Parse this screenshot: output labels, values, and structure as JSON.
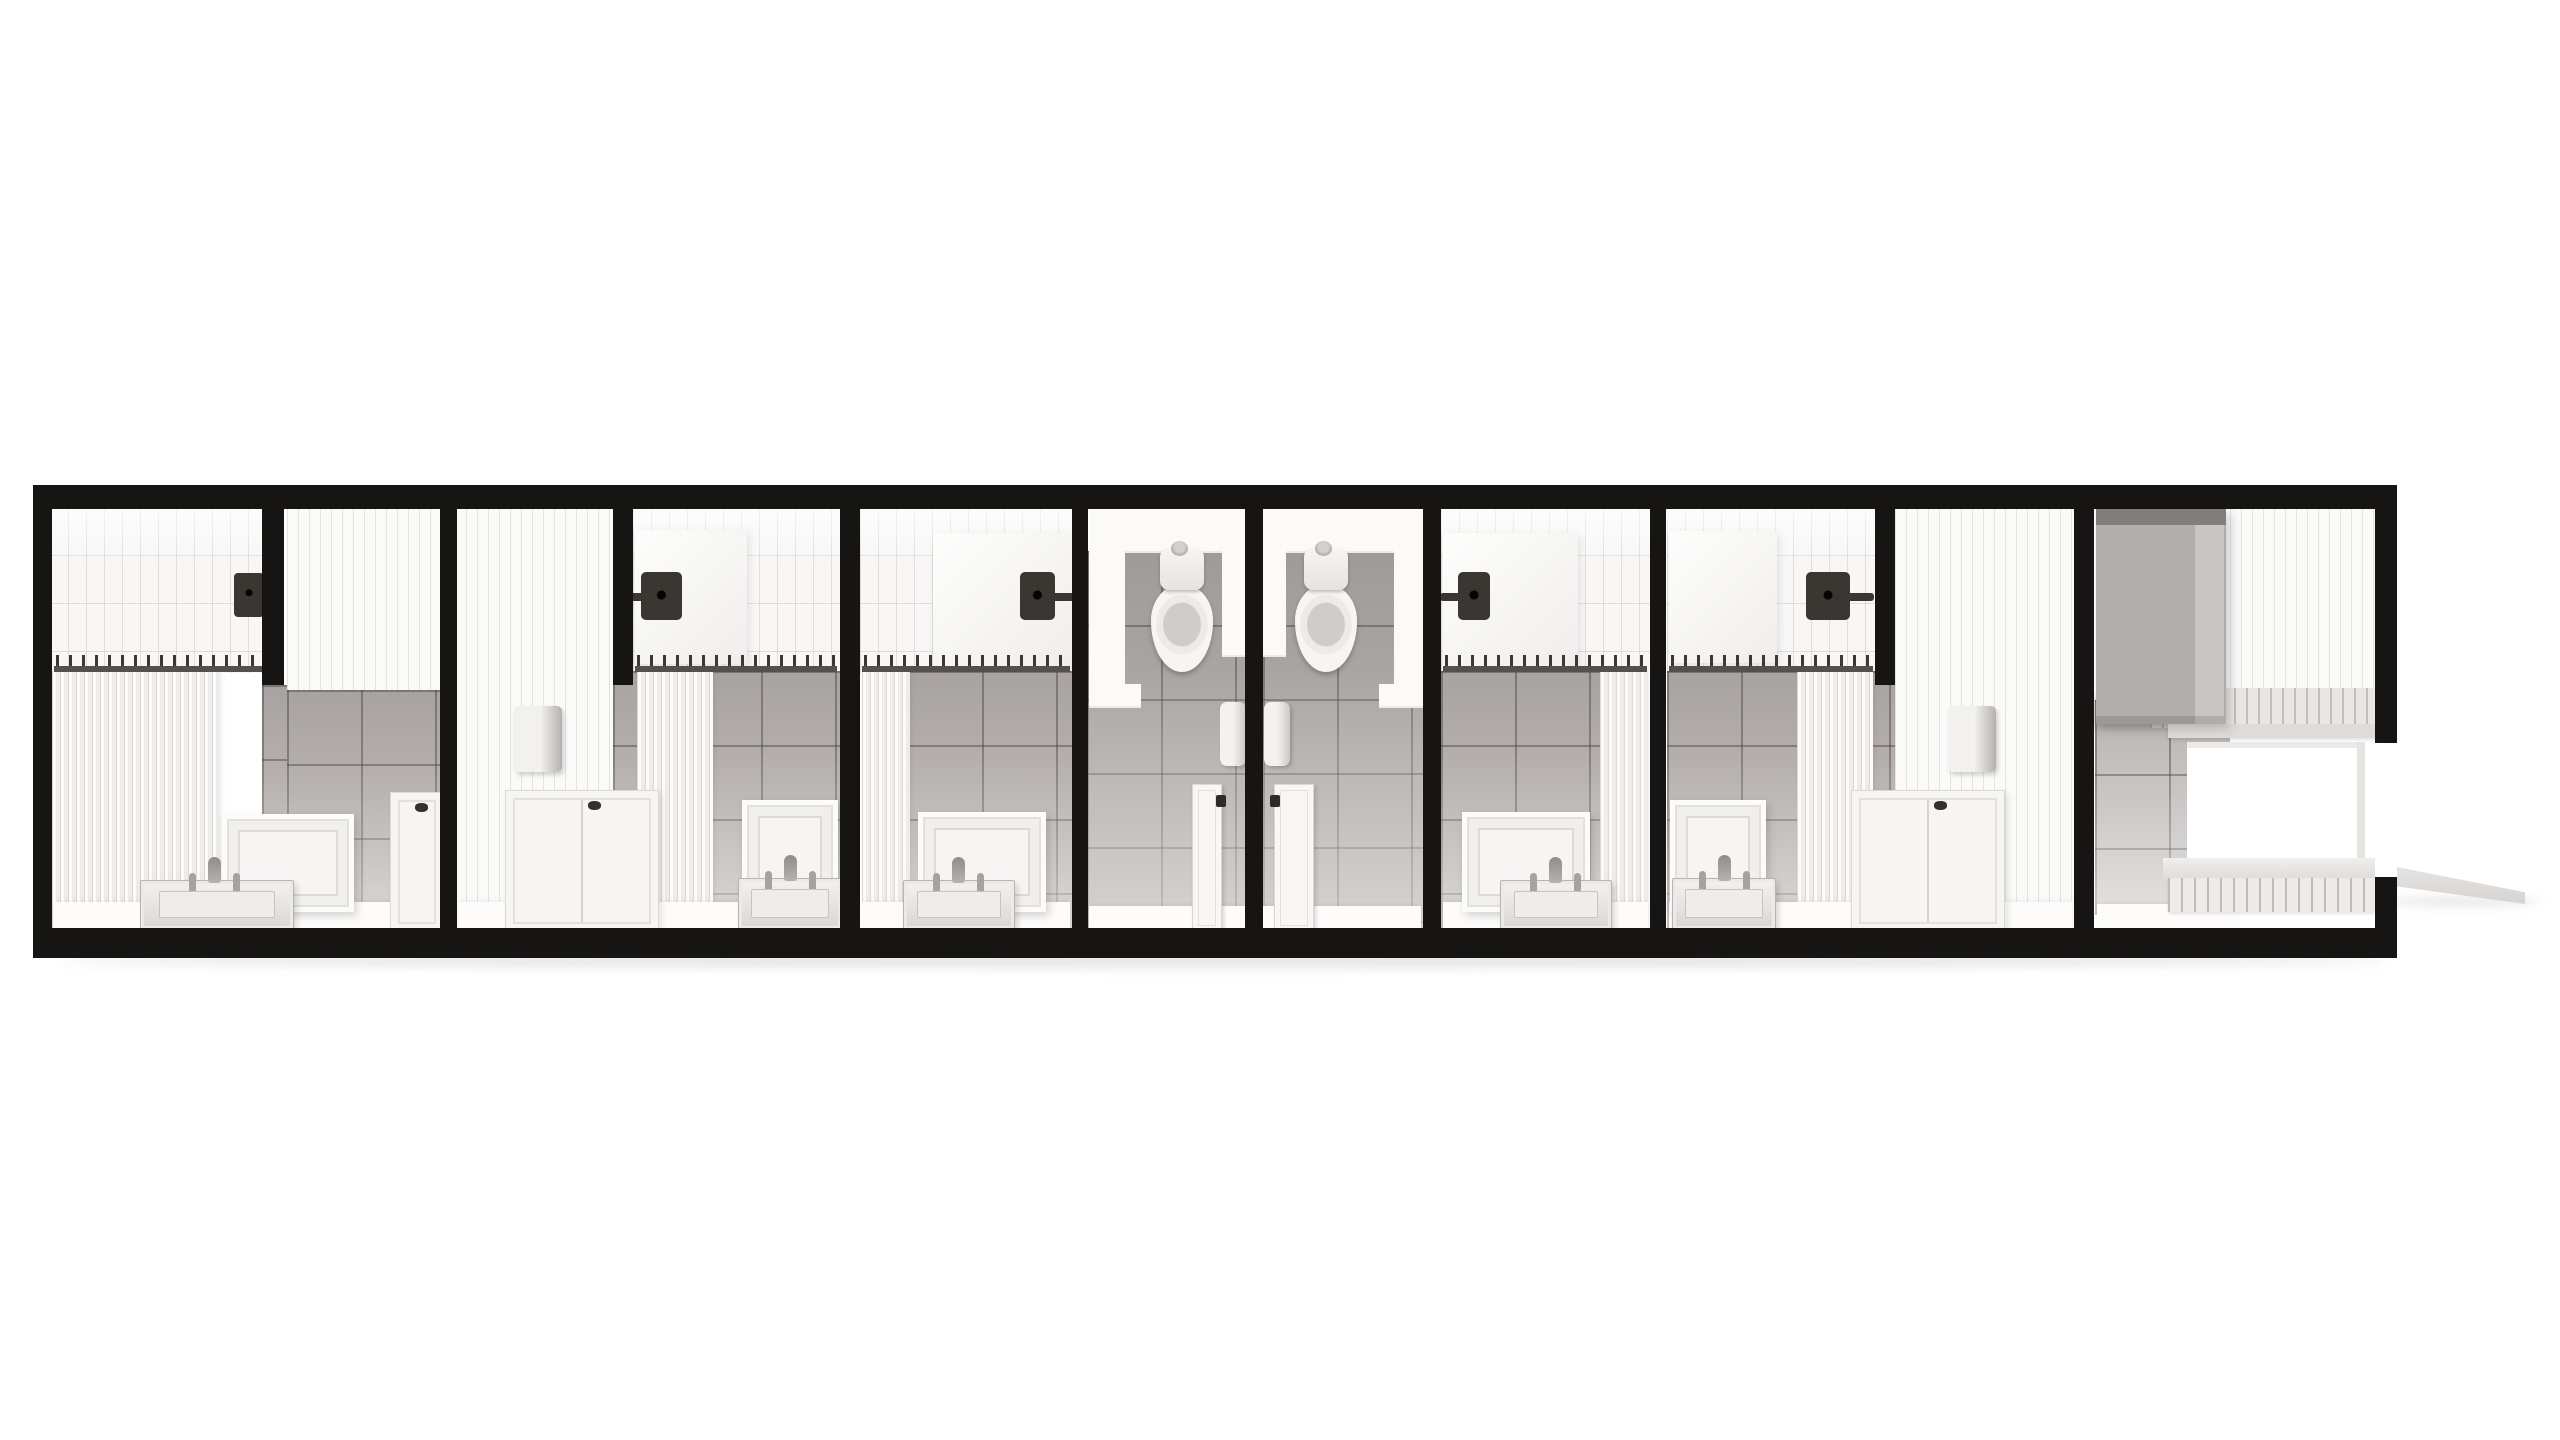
{
  "meta": {
    "scene_label": "Overhead cutaway 3D render of a modular restroom unit: four shower rooms with curtain rods and vanities, two central toilet stalls, panelled storage walls and an entry vestibule with exterior ramp",
    "render_style": "monochrome architectural visualization",
    "view": "top-down dollhouse cutaway"
  },
  "colors": {
    "bg": "#ffffff",
    "frame": "#171514",
    "subway": "#f8f7f6",
    "subwayLine": "rgba(140,134,128,0.22)",
    "panel": "#fafaf9",
    "panelLine": "rgba(140,134,128,0.20)",
    "grayTile": "#b2adab",
    "grayTileDark": "#a8a4a2",
    "grayTileLight": "#c2bfbd",
    "grayLine": "rgba(70,66,63,0.45)",
    "alcove": "#fbfaf9",
    "floorWhite": "#fdfcfb",
    "dark": "#3a3632",
    "rod": "#55504b",
    "rodRing": "#3c3835",
    "heater": "#b2aeac",
    "heaterTop": "#827e7b",
    "shadow": "rgba(100,95,90,0.16)"
  },
  "sections": [
    {
      "id": "suite-1",
      "label": "shower suite with subway-tile shower, curtain, vanity sink and cabinet"
    },
    {
      "id": "suite-2",
      "label": "shower suite with panelled wall, hand dryer, cabinet and vanity sink"
    },
    {
      "id": "shower-room-e",
      "label": "shower room with rain head, curtain and vanity sink"
    },
    {
      "id": "toilet-stall-1",
      "label": "toilet stall with toilet, paper dispenser and swing door"
    },
    {
      "id": "toilet-stall-2",
      "label": "toilet stall with toilet, paper dispenser and swing door"
    },
    {
      "id": "shower-room-f",
      "label": "shower room with rain head, curtain and vanity sink"
    },
    {
      "id": "suite-4",
      "label": "shower suite with panelled wall, hand dryer, cabinet and vanity sink"
    },
    {
      "id": "entry-vestibule",
      "label": "entry vestibule with water heater cabinet, doorway, steps and exterior ramp"
    }
  ],
  "elements": [
    {
      "n": "ground-shadow",
      "k": "shadow",
      "x": 60,
      "y": 954,
      "w": 2330,
      "h": 14
    },
    {
      "n": "ramp-shadow",
      "k": "shadow",
      "x": 2388,
      "y": 897,
      "w": 152,
      "h": 9
    },
    {
      "n": "entry-ramp",
      "k": "ramp",
      "x": 2397,
      "y": 862,
      "w": 128,
      "h": 42
    },
    {
      "n": "shower1-subway-wall",
      "k": "subway",
      "x": 50,
      "y": 507,
      "w": 217,
      "h": 166
    },
    {
      "n": "shower2-subway-wall",
      "k": "subway",
      "x": 633,
      "y": 507,
      "w": 207,
      "h": 166
    },
    {
      "n": "shower3-subway-wall",
      "k": "subway",
      "x": 860,
      "y": 507,
      "w": 212,
      "h": 166
    },
    {
      "n": "shower4-subway-wall",
      "k": "subway",
      "x": 1441,
      "y": 507,
      "w": 209,
      "h": 166
    },
    {
      "n": "shower5-subway-wall",
      "k": "subway",
      "x": 1667,
      "y": 507,
      "w": 208,
      "h": 166
    },
    {
      "n": "suite1-panel-wall",
      "k": "panels",
      "x": 287,
      "y": 507,
      "w": 153,
      "h": 268
    },
    {
      "n": "suite2-panel-wall",
      "k": "panels",
      "x": 455,
      "y": 507,
      "w": 158,
      "h": 422
    },
    {
      "n": "suite4-panel-wall",
      "k": "panels",
      "x": 1895,
      "y": 507,
      "w": 179,
      "h": 422
    },
    {
      "n": "vestibule-panel-wall",
      "k": "panels",
      "x": 2230,
      "y": 507,
      "w": 146,
      "h": 222
    },
    {
      "n": "shower2-surround",
      "k": "inset",
      "x": 635,
      "y": 530,
      "w": 112,
      "h": 134
    },
    {
      "n": "shower3-surround",
      "k": "inset",
      "x": 933,
      "y": 533,
      "w": 139,
      "h": 134
    },
    {
      "n": "shower4-surround",
      "k": "inset",
      "x": 1443,
      "y": 533,
      "w": 135,
      "h": 134
    },
    {
      "n": "shower5-surround",
      "k": "inset",
      "x": 1669,
      "y": 531,
      "w": 108,
      "h": 132
    },
    {
      "n": "suite1-halfwall-tile",
      "k": "graytile",
      "x": 262,
      "y": 685,
      "w": 25,
      "h": 245
    },
    {
      "n": "suite1-lower-tile",
      "k": "graytile",
      "x": 287,
      "y": 690,
      "w": 153,
      "h": 240
    },
    {
      "n": "suite2-lower-tile",
      "k": "graytile",
      "x": 613,
      "y": 671,
      "w": 227,
      "h": 259
    },
    {
      "n": "shower3-lower-tile",
      "k": "graytile",
      "x": 908,
      "y": 671,
      "w": 164,
      "h": 259
    },
    {
      "n": "shower4-lower-tile",
      "k": "graytile",
      "x": 1441,
      "y": 671,
      "w": 162,
      "h": 259
    },
    {
      "n": "suite4-lower-tile",
      "k": "graytile",
      "x": 1667,
      "y": 671,
      "w": 228,
      "h": 259
    },
    {
      "n": "stall1-tile",
      "k": "graytileD",
      "x": 1087,
      "y": 551,
      "w": 158,
      "h": 379
    },
    {
      "n": "stall2-tile",
      "k": "graytileD",
      "x": 1263,
      "y": 551,
      "w": 160,
      "h": 379
    },
    {
      "n": "vestibule-tile",
      "k": "graytileL",
      "x": 2095,
      "y": 700,
      "w": 135,
      "h": 215
    },
    {
      "n": "stall1-alcove-head",
      "k": "alcove",
      "x": 1089,
      "y": 509,
      "w": 156,
      "h": 44
    },
    {
      "n": "stall1-alcove-jamb-left",
      "k": "alcove",
      "x": 1089,
      "y": 509,
      "w": 36,
      "h": 194
    },
    {
      "n": "stall1-alcove-jamb-right",
      "k": "alcove",
      "x": 1222,
      "y": 509,
      "w": 23,
      "h": 148
    },
    {
      "n": "stall1-jamb-foot",
      "k": "alcove",
      "x": 1089,
      "y": 684,
      "w": 52,
      "h": 24
    },
    {
      "n": "stall2-alcove-head",
      "k": "alcove",
      "x": 1263,
      "y": 509,
      "w": 156,
      "h": 44
    },
    {
      "n": "stall2-alcove-jamb-left",
      "k": "alcove",
      "x": 1263,
      "y": 509,
      "w": 23,
      "h": 148
    },
    {
      "n": "stall2-alcove-jamb-right",
      "k": "alcove",
      "x": 1394,
      "y": 509,
      "w": 36,
      "h": 194
    },
    {
      "n": "stall2-jamb-foot",
      "k": "alcove",
      "x": 1379,
      "y": 684,
      "w": 52,
      "h": 24
    },
    {
      "n": "shower1-curtain",
      "k": "pleats",
      "x": 52,
      "y": 671,
      "w": 168,
      "h": 259
    },
    {
      "n": "shower2-curtain",
      "k": "pleats",
      "x": 637,
      "y": 671,
      "w": 76,
      "h": 259
    },
    {
      "n": "shower3-curtain",
      "k": "pleats",
      "x": 862,
      "y": 671,
      "w": 48,
      "h": 259
    },
    {
      "n": "shower4-curtain",
      "k": "pleats",
      "x": 1600,
      "y": 671,
      "w": 48,
      "h": 259
    },
    {
      "n": "shower5-curtain",
      "k": "pleats",
      "x": 1797,
      "y": 671,
      "w": 76,
      "h": 259
    },
    {
      "n": "suite1-floor",
      "k": "floor",
      "x": 54,
      "y": 902,
      "w": 384,
      "h": 28
    },
    {
      "n": "suite2-floor",
      "k": "floor",
      "x": 458,
      "y": 902,
      "w": 380,
      "h": 28
    },
    {
      "n": "shower3-floor",
      "k": "floor",
      "x": 862,
      "y": 902,
      "w": 208,
      "h": 28
    },
    {
      "n": "shower4-floor",
      "k": "floor",
      "x": 1443,
      "y": 902,
      "w": 205,
      "h": 28
    },
    {
      "n": "suite4-floor",
      "k": "floor",
      "x": 1669,
      "y": 902,
      "w": 403,
      "h": 28
    },
    {
      "n": "stall1-floor",
      "k": "floor",
      "x": 1089,
      "y": 906,
      "w": 156,
      "h": 24
    },
    {
      "n": "stall2-floor",
      "k": "floor",
      "x": 1263,
      "y": 906,
      "w": 158,
      "h": 24
    },
    {
      "n": "vestibule-floor",
      "k": "floor",
      "x": 2097,
      "y": 904,
      "w": 140,
      "h": 26
    },
    {
      "n": "vestibule-slat-band",
      "k": "slatband",
      "x": 2150,
      "y": 688,
      "w": 227,
      "h": 40
    },
    {
      "n": "vestibule-ledge",
      "k": "ledge",
      "x": 2168,
      "y": 724,
      "w": 209,
      "h": 14
    },
    {
      "n": "vestibule-doorway",
      "k": "doorway",
      "x": 2187,
      "y": 742,
      "w": 178,
      "h": 150
    },
    {
      "n": "vestibule-step-tread",
      "k": "tread",
      "x": 2163,
      "y": 858,
      "w": 212,
      "h": 24
    },
    {
      "n": "vestibule-step-slats",
      "k": "slats",
      "x": 2168,
      "y": 878,
      "w": 207,
      "h": 34
    },
    {
      "n": "water-heater-cabinet",
      "k": "heater",
      "x": 2096,
      "y": 509,
      "w": 130,
      "h": 215
    },
    {
      "n": "heater-shadow",
      "k": "shade",
      "x": 2092,
      "y": 698,
      "w": 92,
      "h": 30
    },
    {
      "n": "shower1-head-icon",
      "k": "head",
      "x": 234,
      "y": 573,
      "w": 30,
      "h": 44
    },
    {
      "n": "shower2-head-icon",
      "k": "showerArmL",
      "x": 618,
      "y": 572,
      "w": 64,
      "h": 48
    },
    {
      "n": "shower3-head-icon",
      "k": "showerArmR",
      "x": 1020,
      "y": 572,
      "w": 54,
      "h": 48
    },
    {
      "n": "shower4-head-icon",
      "k": "showerArmL",
      "x": 1440,
      "y": 572,
      "w": 50,
      "h": 48
    },
    {
      "n": "shower5-head-icon",
      "k": "showerArmR",
      "x": 1806,
      "y": 572,
      "w": 68,
      "h": 48
    },
    {
      "n": "shower1-curtain-rod",
      "k": "rod",
      "x": 54,
      "y": 655,
      "w": 208,
      "h": 19
    },
    {
      "n": "shower2-curtain-rod",
      "k": "rod",
      "x": 635,
      "y": 655,
      "w": 202,
      "h": 19
    },
    {
      "n": "shower3-curtain-rod",
      "k": "rod",
      "x": 862,
      "y": 655,
      "w": 208,
      "h": 19
    },
    {
      "n": "shower4-curtain-rod",
      "k": "rod",
      "x": 1443,
      "y": 655,
      "w": 204,
      "h": 19
    },
    {
      "n": "shower5-curtain-rod",
      "k": "rod",
      "x": 1669,
      "y": 655,
      "w": 204,
      "h": 19
    },
    {
      "n": "suite2-hand-dryer",
      "k": "dispenser",
      "x": 514,
      "y": 706,
      "w": 48,
      "h": 66
    },
    {
      "n": "suite4-hand-dryer",
      "k": "dispenser",
      "x": 1948,
      "y": 706,
      "w": 48,
      "h": 66
    },
    {
      "n": "stall1-paper-dispenser",
      "k": "tp",
      "x": 1220,
      "y": 702,
      "w": 26,
      "h": 64
    },
    {
      "n": "stall2-paper-dispenser",
      "k": "tp",
      "x": 1264,
      "y": 702,
      "w": 26,
      "h": 64
    },
    {
      "n": "suite1-mirror",
      "k": "mirror",
      "x": 222,
      "y": 814,
      "w": 132,
      "h": 98
    },
    {
      "n": "suite2-mirror",
      "k": "mirror",
      "x": 742,
      "y": 800,
      "w": 96,
      "h": 112
    },
    {
      "n": "shower3-mirror",
      "k": "mirror",
      "x": 918,
      "y": 812,
      "w": 128,
      "h": 100
    },
    {
      "n": "shower4-mirror",
      "k": "mirror",
      "x": 1462,
      "y": 812,
      "w": 128,
      "h": 100
    },
    {
      "n": "suite4-mirror",
      "k": "mirror",
      "x": 1670,
      "y": 800,
      "w": 96,
      "h": 112
    },
    {
      "n": "suite1-sink",
      "k": "sink",
      "x": 140,
      "y": 880,
      "w": 152,
      "h": 48
    },
    {
      "n": "suite2-sink",
      "k": "sink",
      "x": 738,
      "y": 878,
      "w": 102,
      "h": 50
    },
    {
      "n": "shower3-sink",
      "k": "sink",
      "x": 903,
      "y": 880,
      "w": 110,
      "h": 48
    },
    {
      "n": "shower4-sink",
      "k": "sink",
      "x": 1500,
      "y": 880,
      "w": 110,
      "h": 48
    },
    {
      "n": "suite4-sink",
      "k": "sink",
      "x": 1672,
      "y": 878,
      "w": 102,
      "h": 50
    },
    {
      "n": "suite1-cabinet",
      "k": "cabinet",
      "x": 390,
      "y": 792,
      "w": 52,
      "h": 138
    },
    {
      "n": "suite2-cabinet",
      "k": "cabinet2",
      "x": 505,
      "y": 790,
      "w": 152,
      "h": 140
    },
    {
      "n": "suite4-cabinet",
      "k": "cabinet2",
      "x": 1851,
      "y": 790,
      "w": 152,
      "h": 140
    },
    {
      "n": "stall1-door",
      "k": "stalldoor",
      "x": 1192,
      "y": 784,
      "w": 28,
      "h": 146
    },
    {
      "n": "stall2-door",
      "k": "stalldoorR",
      "x": 1274,
      "y": 784,
      "w": 38,
      "h": 146
    },
    {
      "n": "stall1-toilet-tank",
      "k": "tank",
      "x": 1160,
      "y": 548,
      "w": 44,
      "h": 42
    },
    {
      "n": "stall1-toilet-bowl",
      "k": "bowl",
      "x": 1151,
      "y": 584,
      "w": 62,
      "h": 88
    },
    {
      "n": "stall2-toilet-tank",
      "k": "tank",
      "x": 1304,
      "y": 548,
      "w": 44,
      "h": 42
    },
    {
      "n": "stall2-toilet-bowl",
      "k": "bowl",
      "x": 1295,
      "y": 584,
      "w": 62,
      "h": 88
    },
    {
      "n": "half-wall-1",
      "k": "halfwall",
      "x": 262,
      "y": 503,
      "w": 22,
      "h": 182
    },
    {
      "n": "partition-wall-1",
      "k": "wall",
      "x": 440,
      "y": 503,
      "w": 17,
      "h": 427
    },
    {
      "n": "half-wall-2",
      "k": "halfwall",
      "x": 613,
      "y": 503,
      "w": 20,
      "h": 182
    },
    {
      "n": "partition-wall-2",
      "k": "wall",
      "x": 840,
      "y": 503,
      "w": 20,
      "h": 427
    },
    {
      "n": "partition-wall-3",
      "k": "wall",
      "x": 1072,
      "y": 503,
      "w": 16,
      "h": 427
    },
    {
      "n": "partition-wall-4",
      "k": "wall",
      "x": 1245,
      "y": 503,
      "w": 18,
      "h": 427
    },
    {
      "n": "partition-wall-5",
      "k": "wall",
      "x": 1423,
      "y": 503,
      "w": 18,
      "h": 427
    },
    {
      "n": "partition-wall-6",
      "k": "wall",
      "x": 1650,
      "y": 503,
      "w": 16,
      "h": 427
    },
    {
      "n": "half-wall-3",
      "k": "halfwall",
      "x": 1875,
      "y": 503,
      "w": 20,
      "h": 182
    },
    {
      "n": "partition-wall-7",
      "k": "wall",
      "x": 2074,
      "y": 503,
      "w": 20,
      "h": 427
    },
    {
      "n": "unit-frame-top",
      "k": "frame",
      "x": 33,
      "y": 485,
      "w": 2364,
      "h": 24
    },
    {
      "n": "unit-frame-left",
      "k": "frame",
      "x": 33,
      "y": 485,
      "w": 19,
      "h": 473
    },
    {
      "n": "unit-frame-bottom",
      "k": "frame",
      "x": 33,
      "y": 928,
      "w": 2364,
      "h": 30
    },
    {
      "n": "unit-frame-right-upper",
      "k": "frame",
      "x": 2375,
      "y": 485,
      "w": 22,
      "h": 258
    },
    {
      "n": "unit-frame-right-lower",
      "k": "frame",
      "x": 2375,
      "y": 877,
      "w": 22,
      "h": 81
    }
  ]
}
